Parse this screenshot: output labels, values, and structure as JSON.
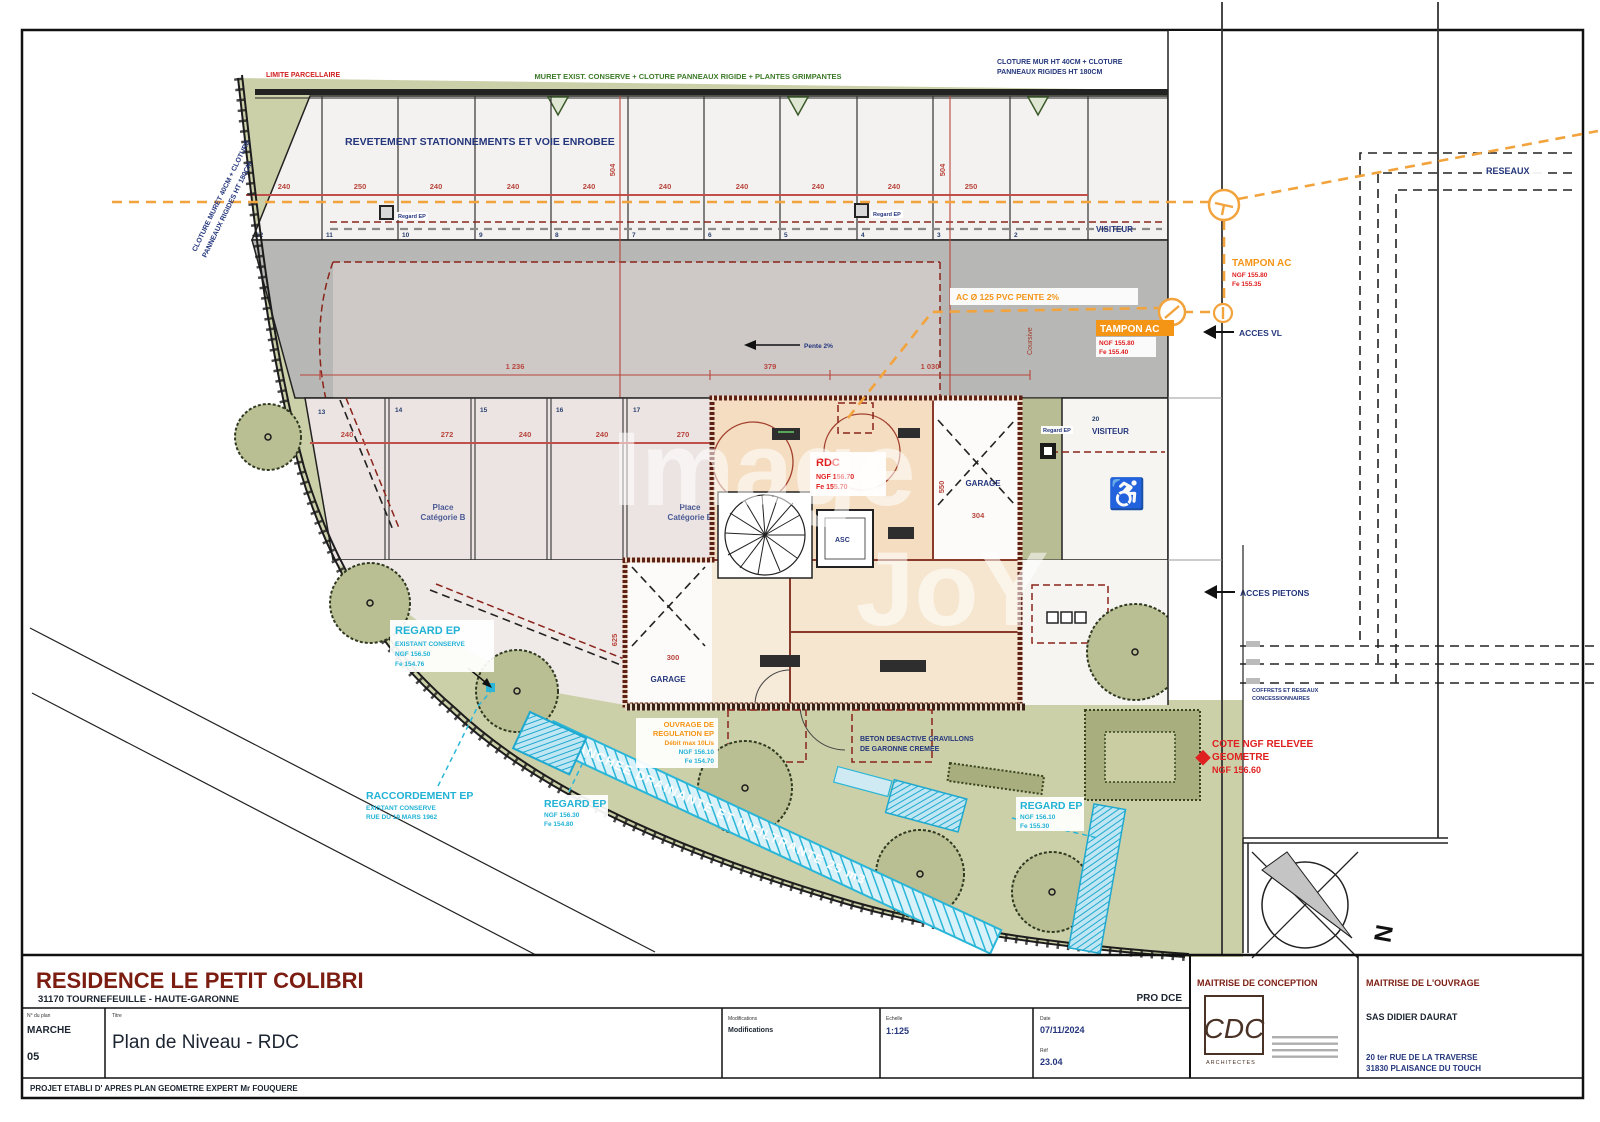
{
  "labels": {
    "limite": "LIMITE PARCELLAIRE",
    "muret_top": "MURET EXIST. CONSERVE + CLOTURE PANNEAUX RIGIDE + PLANTES GRIMPANTES",
    "cloture_tr1": "CLOTURE MUR HT 40CM + CLOTURE",
    "cloture_tr2": "PANNEAUX RIGIDES HT 180CM",
    "cloture_left1": "CLOTURE MURET 40CM + CLOTURE",
    "cloture_left2": "PANNEAUX RIGIDES HT 180CM",
    "revetement": "REVETEMENT STATIONNEMENTS ET VOIE ENROBEE",
    "reseaux": "RESEAUX",
    "visiteur": "VISITEUR",
    "visiteur_no": "1",
    "visiteur2_no": "20",
    "tampon": "TAMPON AC",
    "tampon1_ngf": "NGF 155.80",
    "tampon1_fe": "Fe 155.35",
    "tampon2_ngf": "NGF 155.80",
    "tampon2_fe": "Fe 155.40",
    "ac_pvc": "AC Ø 125 PVC PENTE 2%",
    "acces_vl": "ACCES VL",
    "acces_pietons": "ACCES PIETONS",
    "pente": "Pente 2%",
    "coursive": "Coursive",
    "rdc": "RDC",
    "rdc_ngf": "NGF 156.70",
    "rdc_fe": "Fe 155.70",
    "asc": "ASC",
    "garage": "GARAGE",
    "place1": "Place",
    "place2": "Catégorie B",
    "regard_ep": "REGARD EP",
    "regard_small": "Regard EP",
    "exist_conserve": "EXISTANT CONSERVE",
    "regard1_ngf": "NGF 156.50",
    "regard1_fe": "Fe 154.76",
    "raccordement": "RACCORDEMENT EP",
    "raccordement_rue": "RUE DU 19 MARS 1962",
    "regard2_ngf": "NGF 156.30",
    "regard2_fe": "Fe 154.80",
    "regard3_ngf": "NGF 156.10",
    "regard3_fe": "Fe 155.30",
    "ouvrage1": "OUVRAGE DE",
    "ouvrage2": "REGULATION EP",
    "ouvrage3": "Débit max 10L/s",
    "ouvrage_ngf": "NGF 156.10",
    "ouvrage_fe": "Fe 154.70",
    "beton1": "BETON DESACTIVE GRAVILLONS",
    "beton2": "DE GARONNE CREMEE",
    "tranchee": "TRANCHEE DRAINANTE ET INFILTRANTE 25 m3",
    "cote1": "COTE NGF RELEVEE",
    "cote2": "GEOMETRE",
    "cote3": "NGF 156.60",
    "coffrets1": "COFFRETS ET RESEAUX",
    "coffrets2": "CONCESSIONNAIRES",
    "north": "N",
    "watermark1": "Image",
    "watermark2": "JoY"
  },
  "dims": {
    "top": [
      "240",
      "250",
      "240",
      "240",
      "240",
      "240",
      "240",
      "240",
      "240",
      "250"
    ],
    "mid": [
      "240",
      "272",
      "240",
      "240",
      "270"
    ],
    "band": [
      "1 236",
      "379",
      "1 030"
    ],
    "v504": "504",
    "v550": "550",
    "v625": "625",
    "d304": "304",
    "d300": "300"
  },
  "stalls": {
    "top": [
      "12",
      "11",
      "10",
      "9",
      "8",
      "7",
      "6",
      "5",
      "4",
      "3",
      "2"
    ],
    "mid": [
      "13",
      "14",
      "15",
      "16",
      "17"
    ]
  },
  "title_block": {
    "project": "RESIDENCE LE PETIT COLIBRI",
    "location": "31170 TOURNEFEUILLE  -  HAUTE-GARONNE",
    "phase": "PRO DCE",
    "plan_no_label": "N° du plan",
    "plan_no": "MARCHE",
    "plan_no2": "05",
    "title_label": "Titre",
    "title": "Plan de Niveau - RDC",
    "modifications_label": "Modifications",
    "modifications": "Modifications",
    "scale_label": "Echelle",
    "scale": "1:125",
    "date_label": "Date",
    "date": "07/11/2024",
    "ref_label": "Réf",
    "ref": "23.04",
    "footer": "PROJET ETABLI D' APRES PLAN GEOMETRE EXPERT Mr FOUQUERE",
    "conception_label": "MAITRISE DE CONCEPTION",
    "conception_logo": "CDC",
    "conception_sub": "ARCHITECTES",
    "ouvrage_label": "MAITRISE DE L'OUVRAGE",
    "ouvrage_name": "SAS DIDIER DAURAT",
    "ouvrage_addr1": "20 ter RUE DE LA TRAVERSE",
    "ouvrage_addr2": "31830  PLAISANCE DU TOUCH"
  }
}
